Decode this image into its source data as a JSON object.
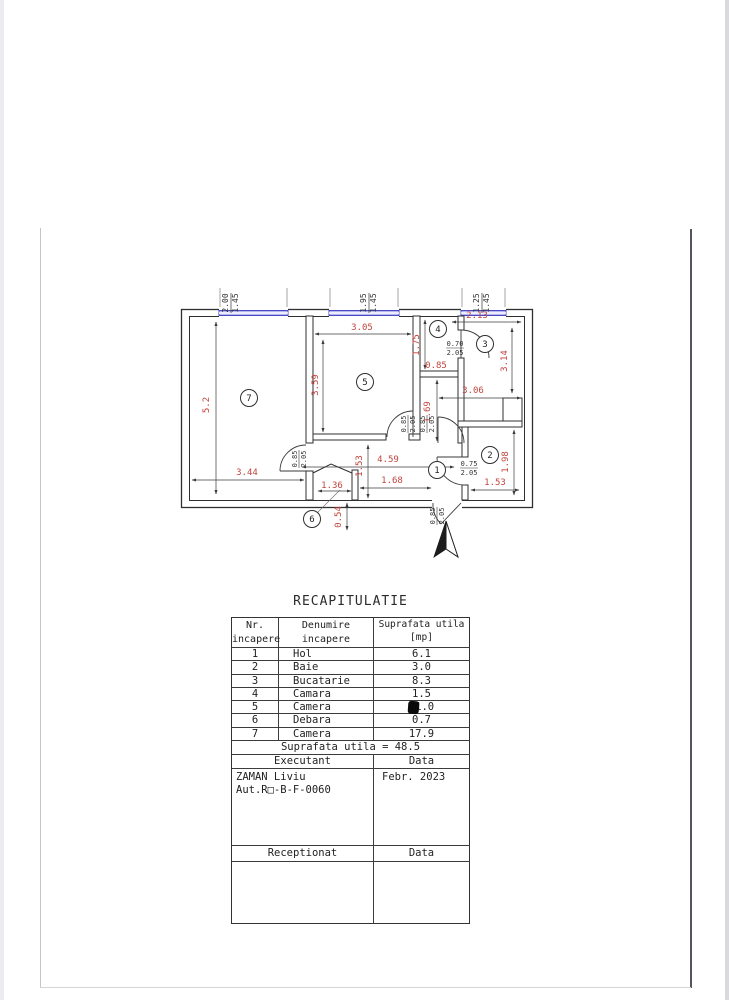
{
  "plan": {
    "window_labels": [
      {
        "width": "2.00",
        "height": "1.45"
      },
      {
        "width": "1.95",
        "height": "1.45"
      },
      {
        "width": "1.25",
        "height": "1.45"
      }
    ],
    "room_numbers": {
      "hol": "1",
      "baie": "2",
      "bucatarie": "3",
      "camara": "4",
      "camera5": "5",
      "debara": "6",
      "camera7": "7"
    },
    "dims": {
      "room7_height": "5.2",
      "room7_width": "3.44",
      "room5_width": "3.05",
      "room5_height": "3.59",
      "hall_length": "4.59",
      "hall_width": "1.53",
      "hall_seg": "1.68",
      "debara_width": "1.36",
      "debara_depth": "0.54",
      "camara_height": "1.75",
      "camara_width": "0.85",
      "kitchen_top": "2.13",
      "kitchen_height": "3.14",
      "kitchen_width": "3.06",
      "channel_height": "1.69",
      "baie_height": "1.98",
      "baie_width": "1.53"
    },
    "door_labels": {
      "room7": {
        "w": "0.85",
        "h": "2.05"
      },
      "room5": {
        "w": "0.85",
        "h": "2.05"
      },
      "channel": {
        "w": "0.85",
        "h": "2.05"
      },
      "camara": {
        "w": "0.70",
        "h": "2.05"
      },
      "baie": {
        "w": "0.75",
        "h": "2.05"
      },
      "entry": {
        "w": "0.85",
        "h": "2.05"
      }
    }
  },
  "table": {
    "title": "RECAPITULATIE",
    "headers": {
      "col1_line1": "Nr.",
      "col1_line2": "incapere",
      "col2_line1": "Denumire",
      "col2_line2": "incapere",
      "col3_line1": "Suprafata utila",
      "col3_line2": "[mp]"
    },
    "rows": [
      {
        "nr": "1",
        "name": "Hol",
        "area": "6.1"
      },
      {
        "nr": "2",
        "name": "Baie",
        "area": "3.0"
      },
      {
        "nr": "3",
        "name": "Bucatarie",
        "area": "8.3"
      },
      {
        "nr": "4",
        "name": "Camara",
        "area": "1.5"
      },
      {
        "nr": "5",
        "name": "Camera",
        "area": "11.0"
      },
      {
        "nr": "6",
        "name": "Debara",
        "area": "0.7"
      },
      {
        "nr": "7",
        "name": "Camera",
        "area": "17.9"
      }
    ],
    "total_text": "Suprafata utila = 48.5",
    "executant_label": "Executant",
    "executant_data_label": "Data",
    "executant_name": "ZAMAN Liviu",
    "executant_auth": "Aut.R□-B-F-0060",
    "executant_date": "Febr. 2023",
    "receptionat_label": "Receptionat",
    "receptionat_data_label": "Data"
  },
  "colors": {
    "dim_red": "#c2453d",
    "window_blue": "#b5b5f0",
    "wall": "#2f2f2f"
  }
}
